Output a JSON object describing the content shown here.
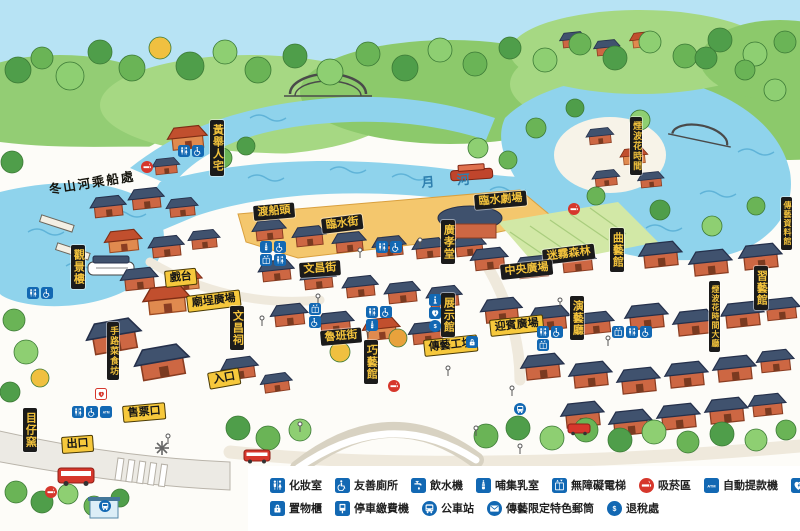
{
  "colors": {
    "legend_blue": "#1268b3",
    "alert_red": "#d6372c",
    "label_black_bg": "#1b1b1b",
    "label_yellow_bg": "#f6c83c",
    "label_gold_text": "#f2c23c",
    "water": "#8fd3ec",
    "sky": "#b7e3f4"
  },
  "map": {
    "water_names": [
      {
        "id": "moon-river",
        "text": "月 河",
        "x": 421,
        "y": 177,
        "rotate": -4
      }
    ],
    "ink_labels": [
      {
        "id": "dongshan-river-pier",
        "text": "冬山河乘船處",
        "x": 48,
        "y": 183,
        "rotate": -9
      }
    ],
    "black_labels": [
      {
        "id": "ferry-dock",
        "text": "渡船頭",
        "x": 253,
        "y": 206,
        "rotate": -5
      },
      {
        "id": "linshui-street",
        "text": "臨水街",
        "x": 321,
        "y": 219,
        "rotate": -7
      },
      {
        "id": "wenchang-street",
        "text": "文昌街",
        "x": 299,
        "y": 263,
        "rotate": -4
      },
      {
        "id": "linshui-theater",
        "text": "臨水劇場",
        "x": 474,
        "y": 195,
        "rotate": -5
      },
      {
        "id": "misty-forest",
        "text": "迷霧森林",
        "x": 542,
        "y": 250,
        "rotate": -7
      },
      {
        "id": "central-plaza",
        "text": "中央廣場",
        "x": 500,
        "y": 265,
        "rotate": -6
      },
      {
        "id": "luban-street",
        "text": "魯班街",
        "x": 320,
        "y": 331,
        "rotate": -5
      }
    ],
    "yellow_labels": [
      {
        "id": "stage",
        "text": "戲台",
        "x": 164,
        "y": 271,
        "rotate": -6
      },
      {
        "id": "temple-plaza",
        "text": "廟埕廣場",
        "x": 186,
        "y": 296,
        "rotate": -7
      },
      {
        "id": "chuanyi-workshop",
        "text": "傳藝工坊",
        "x": 423,
        "y": 340,
        "rotate": -6
      },
      {
        "id": "welcome-plaza",
        "text": "迎賓廣場",
        "x": 489,
        "y": 320,
        "rotate": -6
      },
      {
        "id": "ticket-office",
        "text": "售票口",
        "x": 122,
        "y": 406,
        "rotate": -5
      },
      {
        "id": "exit",
        "text": "出口",
        "x": 61,
        "y": 437,
        "rotate": -4
      },
      {
        "id": "entrance",
        "text": "入口",
        "x": 207,
        "y": 373,
        "rotate": -10
      }
    ],
    "vertical_labels": [
      {
        "id": "huang-juren-residence",
        "text": "黃舉人宅",
        "x": 210,
        "y": 120
      },
      {
        "id": "scenic-tower",
        "text": "觀景樓",
        "x": 71,
        "y": 245
      },
      {
        "id": "muzai-kiln",
        "text": "目仔窯",
        "x": 23,
        "y": 408
      },
      {
        "id": "shoulucai-restaurant",
        "text": "手路菜食坊",
        "x": 107,
        "y": 322,
        "size": 9
      },
      {
        "id": "wenchang-temple",
        "text": "文昌祠",
        "x": 230,
        "y": 306
      },
      {
        "id": "qiaoyi-hall",
        "text": "巧藝館",
        "x": 364,
        "y": 340
      },
      {
        "id": "exhibition-hall",
        "text": "展示館",
        "x": 441,
        "y": 293
      },
      {
        "id": "guangxiao-hall",
        "text": "廣孝堂",
        "x": 441,
        "y": 220
      },
      {
        "id": "quyi-hall",
        "text": "曲藝館",
        "x": 610,
        "y": 228
      },
      {
        "id": "performance-hall",
        "text": "演藝廳",
        "x": 570,
        "y": 296
      },
      {
        "id": "yanbo-huashijian",
        "text": "煙波花時間",
        "x": 630,
        "y": 117,
        "size": 9
      },
      {
        "id": "yanbo-lobby",
        "text": "煙波花時間大廳",
        "x": 709,
        "y": 281,
        "size": 8
      },
      {
        "id": "xiyi-hall",
        "text": "習藝館",
        "x": 754,
        "y": 266
      },
      {
        "id": "chuanyi-archives",
        "text": "傳藝資料館",
        "x": 781,
        "y": 197,
        "size": 8
      }
    ],
    "markers": [
      {
        "icons": [
          "restroom",
          "accessible"
        ],
        "x": 178,
        "y": 145,
        "cols": 2
      },
      {
        "icons": [
          "restroom",
          "accessible"
        ],
        "x": 27,
        "y": 287,
        "cols": 2
      },
      {
        "icons": [
          "nursing",
          "accessible",
          "elevator",
          "restroom"
        ],
        "x": 260,
        "y": 241,
        "cols": 2
      },
      {
        "icons": [
          "restroom",
          "accessible"
        ],
        "x": 376,
        "y": 241,
        "cols": 2
      },
      {
        "icons": [
          "elevator",
          "accessible"
        ],
        "x": 309,
        "y": 303,
        "cols": 1
      },
      {
        "icons": [
          "restroom",
          "accessible",
          "nursing"
        ],
        "x": 366,
        "y": 306,
        "cols": 2
      },
      {
        "icons": [
          "info",
          "aed",
          "tax"
        ],
        "x": 429,
        "y": 294,
        "cols": 1
      },
      {
        "icons": [
          "locker"
        ],
        "x": 466,
        "y": 336,
        "cols": 1
      },
      {
        "icons": [
          "restroom",
          "accessible",
          "elevator"
        ],
        "x": 537,
        "y": 326,
        "cols": 2
      },
      {
        "icons": [
          "elevator",
          "restroom",
          "accessible"
        ],
        "x": 612,
        "y": 326,
        "cols": 3
      },
      {
        "icons": [
          "bus"
        ],
        "x": 514,
        "y": 403,
        "cols": 1
      },
      {
        "icons": [
          "restroom",
          "accessible",
          "atm"
        ],
        "x": 72,
        "y": 406,
        "cols": 3
      },
      {
        "icons": [
          "aed"
        ],
        "x": 95,
        "y": 388,
        "cols": 1,
        "theme": "red"
      },
      {
        "icons": [
          "smoking"
        ],
        "x": 141,
        "y": 161,
        "cols": 1
      },
      {
        "icons": [
          "smoking"
        ],
        "x": 568,
        "y": 203,
        "cols": 1
      },
      {
        "icons": [
          "smoking"
        ],
        "x": 388,
        "y": 380,
        "cols": 1
      },
      {
        "icons": [
          "smoking"
        ],
        "x": 45,
        "y": 486,
        "cols": 1
      },
      {
        "icons": [
          "bus"
        ],
        "x": 99,
        "y": 500,
        "cols": 1
      }
    ]
  },
  "legend": {
    "rows": [
      {
        "items": [
          {
            "icon": "restroom",
            "label": "化妝室"
          },
          {
            "icon": "accessible",
            "label": "友善廁所"
          },
          {
            "icon": "water",
            "label": "飲水機"
          },
          {
            "icon": "nursing",
            "label": "哺集乳室"
          },
          {
            "icon": "elevator",
            "label": "無障礙電梯"
          },
          {
            "icon": "smoking",
            "label": "吸菸區"
          },
          {
            "icon": "atm",
            "label": "自動提款機"
          },
          {
            "icon": "aed",
            "label": "自動電擊器AED"
          },
          {
            "icon": "info",
            "label": "遊客資訊站"
          }
        ]
      },
      {
        "items": [
          {
            "icon": "locker",
            "label": "置物櫃"
          },
          {
            "icon": "parking",
            "label": "停車繳費機"
          },
          {
            "icon": "bus",
            "label": "公車站"
          },
          {
            "icon": "mail",
            "label": "傳藝限定特色郵筒"
          },
          {
            "icon": "tax",
            "label": "退稅處"
          }
        ]
      }
    ]
  }
}
